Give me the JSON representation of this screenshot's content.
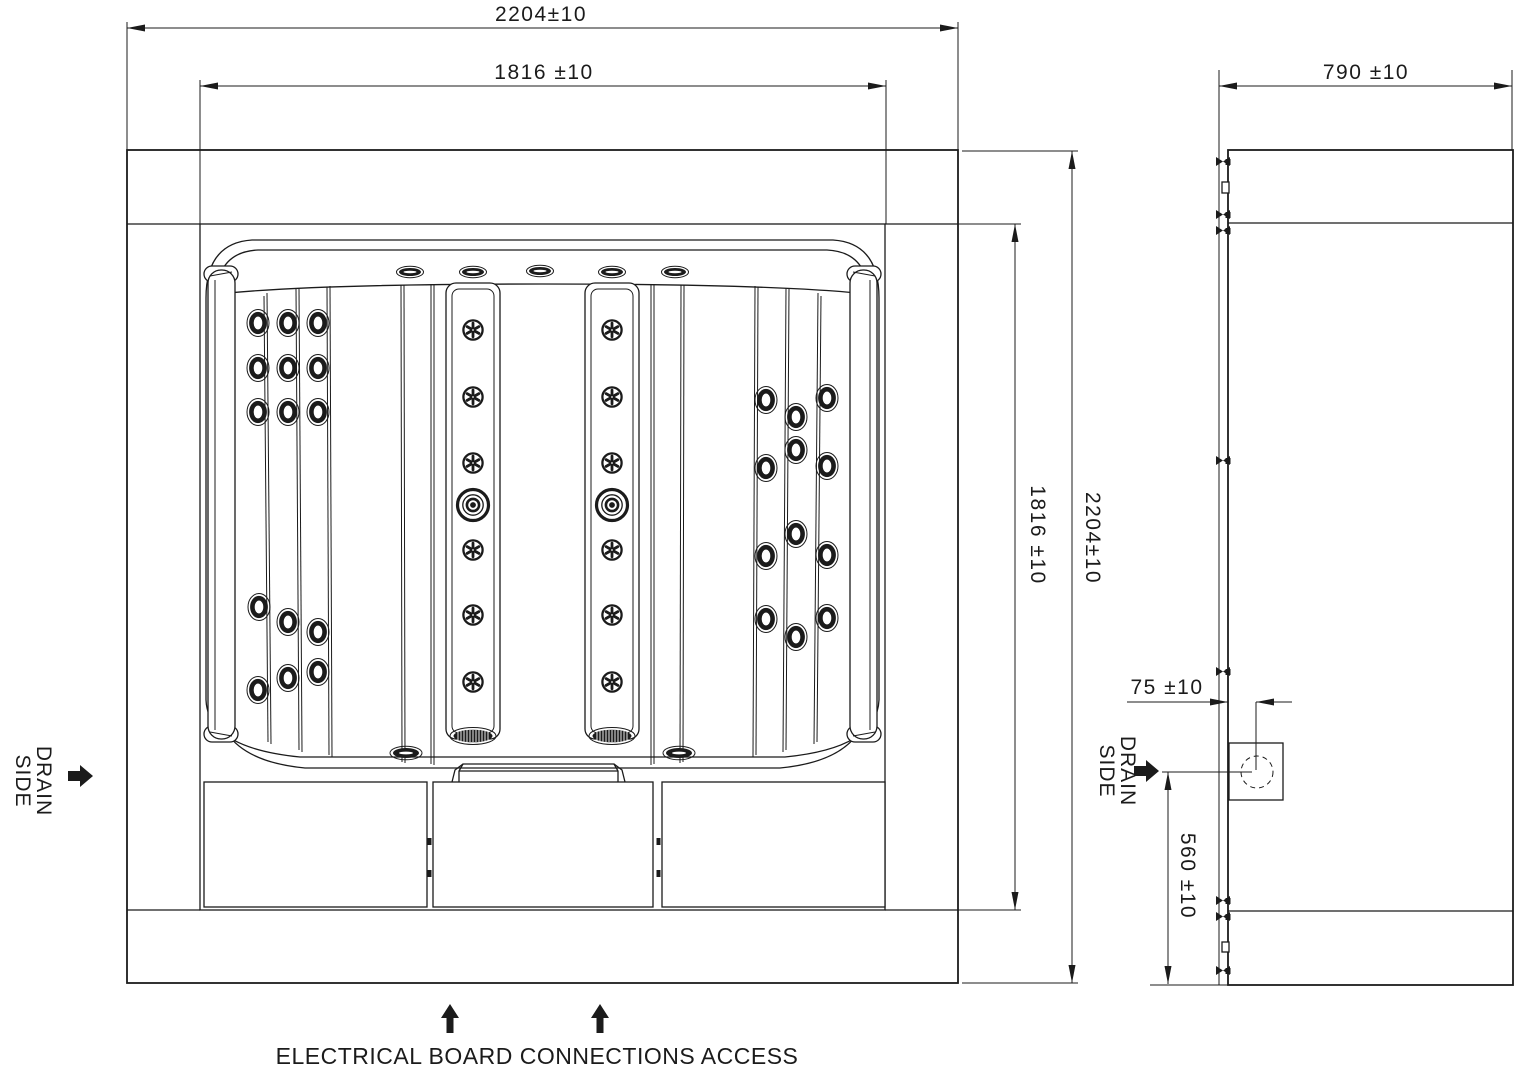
{
  "colors": {
    "line": "#1b1b1b",
    "background": "#ffffff"
  },
  "front_view": {
    "overall_width": "2204±10",
    "inner_width": "1816 ±10",
    "inner_height": "1816 ±10",
    "overall_height": "2204±10",
    "drain_side": {
      "line1": "DRAIN",
      "line2": "SIDE"
    }
  },
  "side_view": {
    "overall_depth": "790 ±10",
    "drain_offset": "75 ±10",
    "drain_height": "560 ±10",
    "drain_side": {
      "line1": "DRAIN",
      "line2": "SIDE"
    }
  },
  "footer": {
    "note": "ELECTRICAL BOARD CONNECTIONS ACCESS"
  }
}
